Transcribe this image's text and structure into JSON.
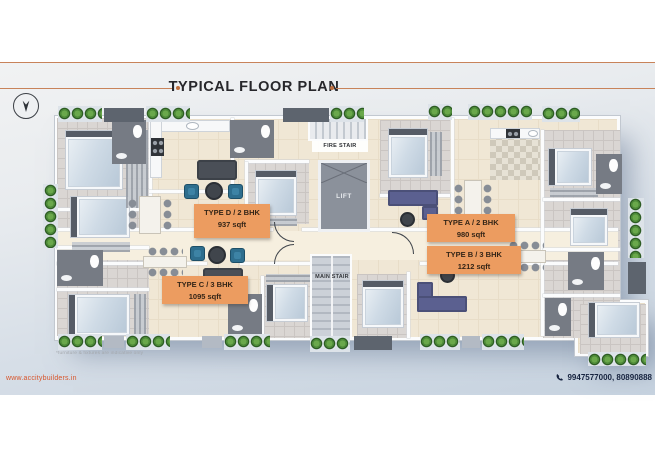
{
  "page": {
    "title": "TYPICAL FLOOR PLAN",
    "website": "www.accitybuilders.in",
    "phone": "9947577000, 80890888",
    "disclaimer": "*furniture & fixtures are indicative only"
  },
  "units": [
    {
      "name": "TYPE D / 2 BHK",
      "area": "937 sqft"
    },
    {
      "name": "TYPE A / 2 BHK",
      "area": "980 sqft"
    },
    {
      "name": "TYPE B / 3 BHK",
      "area": "1212 sqft"
    },
    {
      "name": "TYPE C / 3 BHK",
      "area": "1095 sqft"
    }
  ],
  "core": {
    "fire_stair": "FIRE STAIR",
    "lift": "LIFT",
    "main_stair": "MAIN STAIR"
  },
  "icons": {
    "north": "north-arrow-icon",
    "phone": "phone-icon"
  },
  "colors": {
    "accent_orange": "#c8835a",
    "label_orange": "#ec9c60",
    "website_text": "#d8562c",
    "phone_text": "#16233f",
    "floor_cream": "#f0e7d5",
    "band_bottom": "#c7d3e0"
  }
}
